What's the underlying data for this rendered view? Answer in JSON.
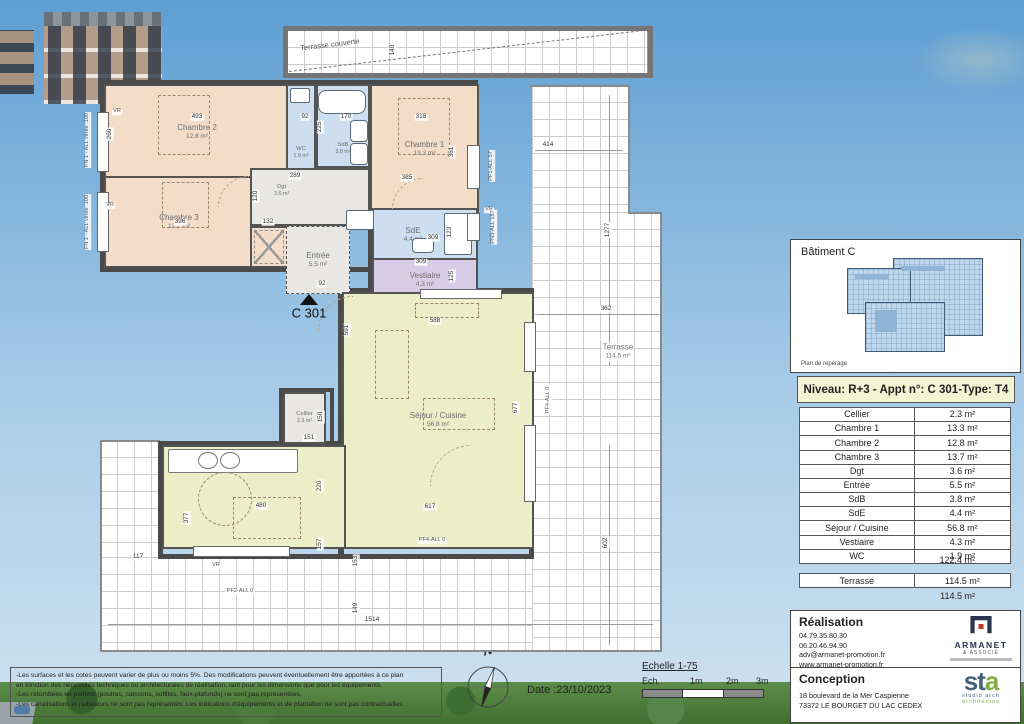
{
  "title_block": {
    "residence_line1": "Résidence DOMAINE DE",
    "residence_line2": "BEAUVOIR",
    "address_line1": "Rue Victor Hugo & Rue Jean Moulin",
    "address_line2": "73190 CHALLES-LES-EAUX",
    "plan_type": "PLAN DE VENTE"
  },
  "building": {
    "label": "Bâtiment C",
    "locator_caption": "Plan de repérage"
  },
  "apartment": {
    "header": "Niveau: R+3  - Appt n°: C 301-Type: T4",
    "rooms": [
      {
        "name": "Cellier",
        "area": "2.3 m²"
      },
      {
        "name": "Chambre 1",
        "area": "13.3 m²"
      },
      {
        "name": "Chambre 2",
        "area": "12.8 m²"
      },
      {
        "name": "Chambre 3",
        "area": "13.7 m²"
      },
      {
        "name": "Dgt",
        "area": "3.6 m²"
      },
      {
        "name": "Entrée",
        "area": "5.5 m²"
      },
      {
        "name": "SdB",
        "area": "3.8 m²"
      },
      {
        "name": "SdE",
        "area": "4.4 m²"
      },
      {
        "name": "Séjour / Cuisine",
        "area": "56.8 m²"
      },
      {
        "name": "Vestiaire",
        "area": "4.3 m²"
      },
      {
        "name": "WC",
        "area": "1.9 m²"
      }
    ],
    "total": "122.4 m²",
    "terrasse": {
      "name": "Terrasse",
      "area": "114.5 m²"
    },
    "terrasse_total": "114.5 m²"
  },
  "realisation": {
    "title": "Réalisation",
    "lines": [
      "04.79.35.80.30",
      "06.20.46.94.90",
      "adv@armanet-promotion.fr",
      "www.armanet-promotion.fr"
    ],
    "logo_name": "ARMANET",
    "logo_sub": "& ASSOCIÉ"
  },
  "conception": {
    "title": "Conception",
    "lines": [
      "18 boulevard de la Mer Caspienne",
      "73372 LE BOURGET DU LAC CEDEX"
    ],
    "logo_name_st": "st",
    "logo_name_a": "a",
    "logo_sub1": "studio arch",
    "logo_sub2": "architectes"
  },
  "footer": {
    "notes": [
      "-Les surfaces et les cotes peuvent varier de plus ou moins 5%. Des modifications peuvent éventuellement être apportées à ce plan",
      "en fonction des nécessités techniques ou architecturales de réalisation, tant pour les dimensions que pour les équipements.",
      "-Les retombées en plafond (poutres, caissons, soffites, faux-plafonds) ne sont pas représentées.",
      "-Les canalisations et radiateurs ne sont pas représentés. Les indications d'équipements et de plantation ne sont pas contractuelles."
    ],
    "date_label": "Date :23/10/2023",
    "scale_title": "Echelle 1-75",
    "scale_labels": [
      "Ech.",
      "1m",
      "2m",
      "3m"
    ],
    "north": "N"
  },
  "plan": {
    "unit": "C 301",
    "rooms": {
      "chambre2": {
        "name": "Chambre 2",
        "area": "12.8 m²"
      },
      "chambre3": {
        "name": "Chambre 3",
        "area": "13.7 m²"
      },
      "chambre1": {
        "name": "Chambre 1",
        "area": "13.3 m²"
      },
      "wc": {
        "name": "WC",
        "area": "1.9 m²"
      },
      "sdb": {
        "name": "SdB",
        "area": "3.8 m²"
      },
      "sde": {
        "name": "SdE",
        "area": "4.4 m²"
      },
      "dgt": {
        "name": "Dgt",
        "area": "3.6 m²"
      },
      "entree": {
        "name": "Entrée",
        "area": "5.5 m²"
      },
      "vestiaire": {
        "name": "Vestiaire",
        "area": "4.3 m²"
      },
      "cellier": {
        "name": "Cellier",
        "area": "2.3 m²"
      },
      "sejour": {
        "name": "Séjour / Cuisine",
        "area": "56.8 m²"
      },
      "terrasse": {
        "name": "Terrasse",
        "area": "114.5 m²"
      },
      "terrasse_couverte": "Terrasse couverte"
    },
    "dimensions": [
      {
        "t": "493",
        "x": 197,
        "y": 117
      },
      {
        "t": "92",
        "x": 305,
        "y": 117
      },
      {
        "t": "170",
        "x": 346,
        "y": 117
      },
      {
        "t": "225",
        "x": 320,
        "y": 127,
        "v": 1
      },
      {
        "t": "318",
        "x": 421,
        "y": 117
      },
      {
        "t": "140",
        "x": 393,
        "y": 50,
        "v": 1
      },
      {
        "t": "414",
        "x": 548,
        "y": 145
      },
      {
        "t": "260",
        "x": 110,
        "y": 134,
        "v": 1
      },
      {
        "t": "361",
        "x": 452,
        "y": 152,
        "v": 1
      },
      {
        "t": "289",
        "x": 295,
        "y": 176
      },
      {
        "t": "385",
        "x": 407,
        "y": 178
      },
      {
        "t": "396",
        "x": 180,
        "y": 222
      },
      {
        "t": "132",
        "x": 268,
        "y": 222
      },
      {
        "t": "120",
        "x": 256,
        "y": 196,
        "v": 1
      },
      {
        "t": "1277",
        "x": 608,
        "y": 230,
        "v": 1
      },
      {
        "t": "309",
        "x": 433,
        "y": 238
      },
      {
        "t": "123",
        "x": 450,
        "y": 232,
        "v": 1
      },
      {
        "t": "309",
        "x": 421,
        "y": 262
      },
      {
        "t": "125",
        "x": 452,
        "y": 276,
        "v": 1
      },
      {
        "t": "92",
        "x": 322,
        "y": 284
      },
      {
        "t": "362",
        "x": 606,
        "y": 309
      },
      {
        "t": "591",
        "x": 347,
        "y": 330,
        "v": 1
      },
      {
        "t": "588",
        "x": 435,
        "y": 321
      },
      {
        "t": "677",
        "x": 516,
        "y": 408,
        "v": 1
      },
      {
        "t": "150",
        "x": 321,
        "y": 417,
        "v": 1
      },
      {
        "t": "151",
        "x": 309,
        "y": 438
      },
      {
        "t": "220",
        "x": 320,
        "y": 486,
        "v": 1
      },
      {
        "t": "480",
        "x": 261,
        "y": 506
      },
      {
        "t": "377",
        "x": 187,
        "y": 518,
        "v": 1
      },
      {
        "t": "157",
        "x": 320,
        "y": 544,
        "v": 1
      },
      {
        "t": "617",
        "x": 430,
        "y": 507
      },
      {
        "t": "153",
        "x": 356,
        "y": 561,
        "v": 1
      },
      {
        "t": "149",
        "x": 356,
        "y": 608,
        "v": 1
      },
      {
        "t": "1514",
        "x": 372,
        "y": 620
      },
      {
        "t": "602",
        "x": 606,
        "y": 543,
        "v": 1
      },
      {
        "t": "117",
        "x": 138,
        "y": 557
      }
    ],
    "openings": [
      {
        "t": "FN 1 - ALL vitrée :100",
        "x": 88,
        "y": 140,
        "v": 1
      },
      {
        "t": "FN 1 - ALL vitrée :100",
        "x": 88,
        "y": 222,
        "v": 1
      },
      {
        "t": "VR",
        "x": 117,
        "y": 112
      },
      {
        "t": "VR",
        "x": 110,
        "y": 206
      },
      {
        "t": "VR",
        "x": 489,
        "y": 210
      },
      {
        "t": "VR",
        "x": 216,
        "y": 566
      },
      {
        "t": "PF1-ALL 57",
        "x": 492,
        "y": 166,
        "v": 1
      },
      {
        "t": "PN3-ALL 157",
        "x": 494,
        "y": 227,
        "v": 1
      },
      {
        "t": "PF4-ALL 0",
        "x": 549,
        "y": 400,
        "v": 1
      },
      {
        "t": "PF4-ALL 0",
        "x": 432,
        "y": 541
      },
      {
        "t": "PF2-ALL 0",
        "x": 240,
        "y": 592
      }
    ]
  }
}
